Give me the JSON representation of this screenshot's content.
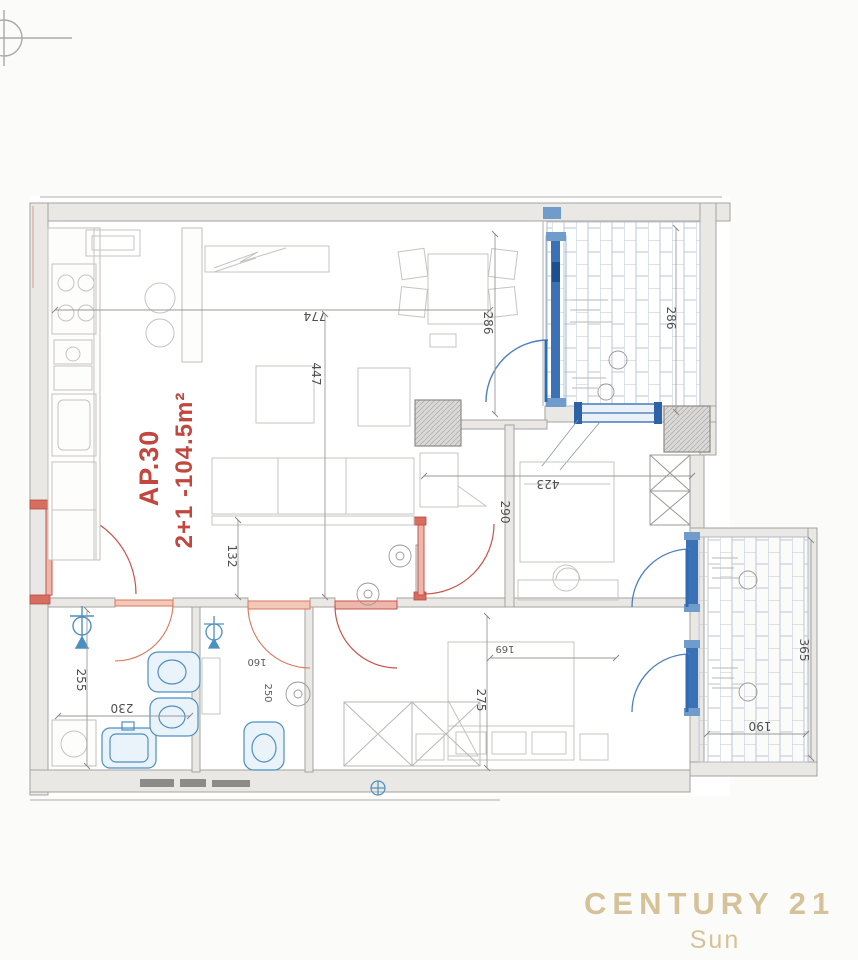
{
  "apartment": {
    "code": "AP.30",
    "spec": "2+1 -104.5m²",
    "label_color": "#c2473f"
  },
  "watermark": {
    "brand": "CENTURY 21",
    "agency": "Sun",
    "color": "#d5c298"
  },
  "colors": {
    "blue_joinery": "#3a72b5",
    "red_doors": "#c9524b",
    "walls": "#a5a3a0",
    "brick_hatch": "#bcc7d6"
  },
  "dimensions": {
    "living_width": "774",
    "living_depth": "447",
    "dining_depth": "286",
    "balcony_top_depth": "286",
    "room_right_width": "423",
    "room_right_depth": "290",
    "hall_width": "132",
    "bath1_depth": "255",
    "bath1_width": "230",
    "bath2_a": "160",
    "bath2_b": "250",
    "bedroom_depth": "275",
    "bedroom_width": "169",
    "balcony_right_depth": "365",
    "balcony_right_width": "190"
  }
}
